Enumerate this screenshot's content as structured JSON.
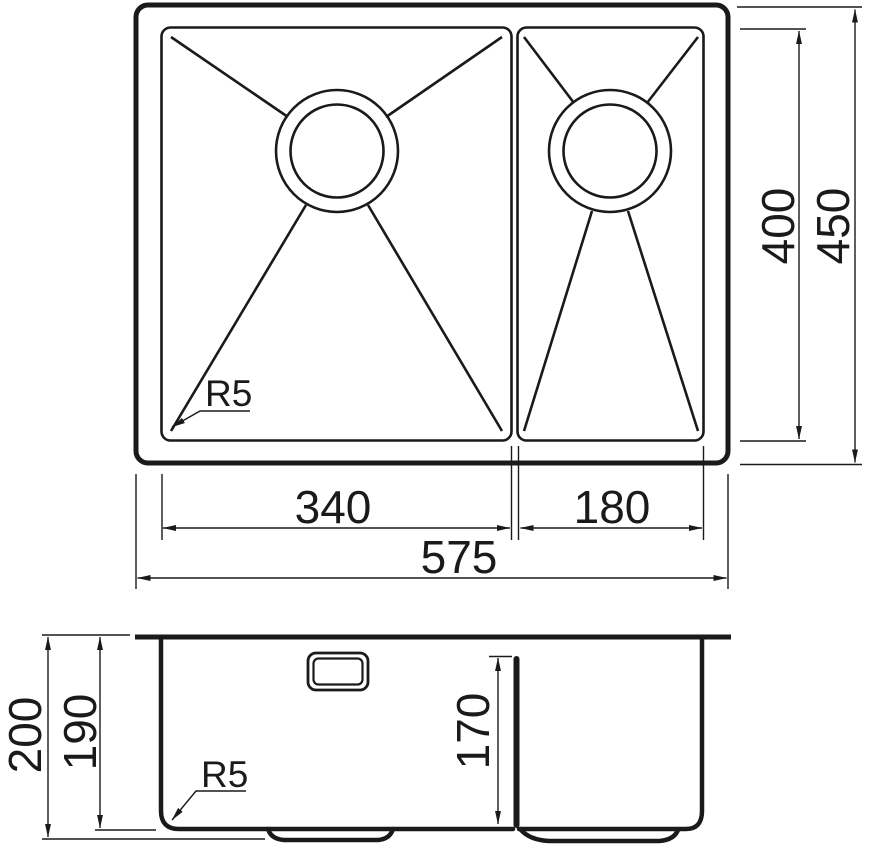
{
  "drawing": {
    "subject": "double-bowl-sink-technical-drawing",
    "colors": {
      "line": "#1a1a1a",
      "background": "#ffffff"
    },
    "labels": {
      "top_view": {
        "main_bowl_width": "340",
        "half_bowl_width": "180",
        "overall_width": "575",
        "bowl_length": "400",
        "overall_length": "450",
        "corner_radius": "R5"
      },
      "section_view": {
        "overall_depth": "200",
        "main_bowl_depth": "190",
        "half_bowl_depth": "170",
        "corner_radius": "R5"
      }
    }
  }
}
